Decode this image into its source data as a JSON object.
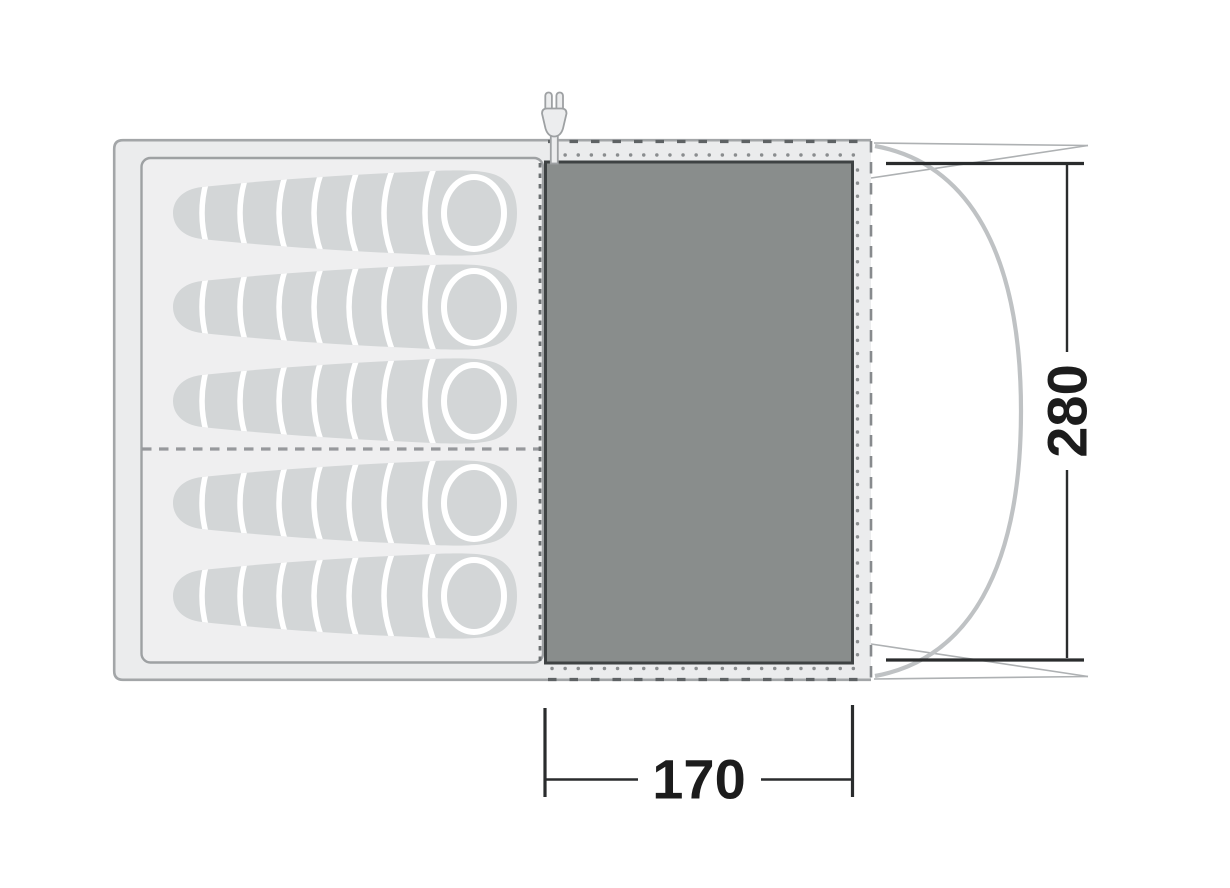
{
  "diagram": {
    "type": "tent-floorplan",
    "dimensions": {
      "vertical_label": "280",
      "horizontal_label": "170"
    },
    "sleeping_bags": {
      "count": 5
    },
    "icons": {
      "plug": "electric-hookup-plug-icon"
    },
    "colors": {
      "canvas": "#FFFFFF",
      "tent_fill": "#EBECED",
      "tent_border": "#A3A6A8",
      "cabin_fill": "#EFEFF0",
      "cabin_border": "#9EA1A3",
      "bag_fill": "#D3D6D7",
      "bag_divider": "#FFFFFF",
      "room_fill": "#898D8C",
      "room_border": "#3E4243",
      "zipper_dash": "#5E6264",
      "dot_line": "#8A8D8F",
      "pole_arc": "#BFC2C4",
      "canopy_line": "#AEB1B3",
      "dimension": "#2A2C2D"
    }
  }
}
